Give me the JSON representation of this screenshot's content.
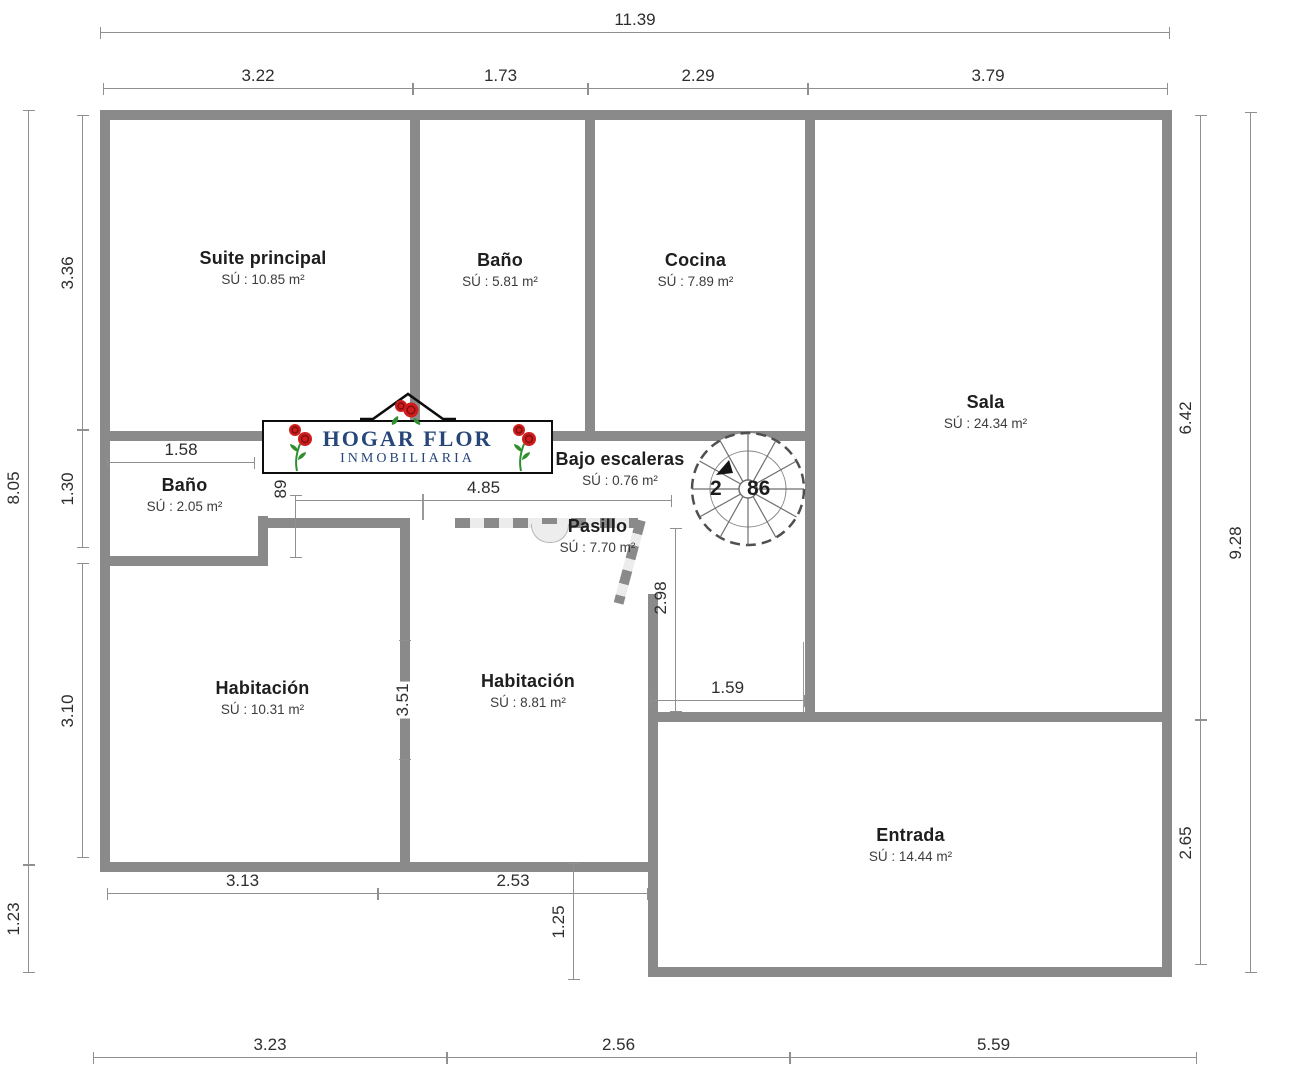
{
  "brand": {
    "title": "HOGAR FLOR",
    "subtitle": "INMOBILIARIA"
  },
  "rooms": {
    "suite": {
      "name": "Suite principal",
      "area": "SÚ : 10.85 m²"
    },
    "bano_top": {
      "name": "Baño",
      "area": "SÚ : 5.81 m²"
    },
    "cocina": {
      "name": "Cocina",
      "area": "SÚ : 7.89 m²"
    },
    "sala": {
      "name": "Sala",
      "area": "SÚ : 24.34 m²"
    },
    "bano_small": {
      "name": "Baño",
      "area": "SÚ : 2.05 m²"
    },
    "bajo_escaleras": {
      "name": "Bajo escaleras",
      "area": "SÚ : 0.76 m²"
    },
    "pasillo": {
      "name": "Pasillo",
      "area": "SÚ : 7.70 m²"
    },
    "habitacion_left": {
      "name": "Habitación",
      "area": "SÚ : 10.31 m²"
    },
    "habitacion_center": {
      "name": "Habitación",
      "area": "SÚ : 8.81 m²"
    },
    "entrada": {
      "name": "Entrada",
      "area": "SÚ : 14.44 m²"
    }
  },
  "dimensions": {
    "top_total": "11.39",
    "top_row": [
      "3.22",
      "1.73",
      "2.29",
      "3.79"
    ],
    "left_outer": [
      "8.05",
      "1.23"
    ],
    "left_inner": [
      "3.36",
      "1.30",
      "3.10"
    ],
    "right_inner": [
      "6.42",
      "2.65"
    ],
    "right_outer": "9.28",
    "bottom_mid": [
      "3.13",
      "2.53"
    ],
    "bottom_row": [
      "3.23",
      "2.56",
      "5.59"
    ],
    "interior": {
      "bath_width": "1.58",
      "corridor_width": "89",
      "hall_length": "4.85",
      "hall_drop": "2.98",
      "stair_landing": "1.59",
      "room_divider": "3.51",
      "entry_step": "1.25"
    }
  },
  "stairs": {
    "label_left": "2",
    "label_right": "86"
  },
  "colors": {
    "wall": "#8a8a8a",
    "dimension_line": "#909090",
    "brand_blue": "#27477a",
    "rose_red": "#cf1d1d",
    "stem_green": "#2f8f2f"
  }
}
